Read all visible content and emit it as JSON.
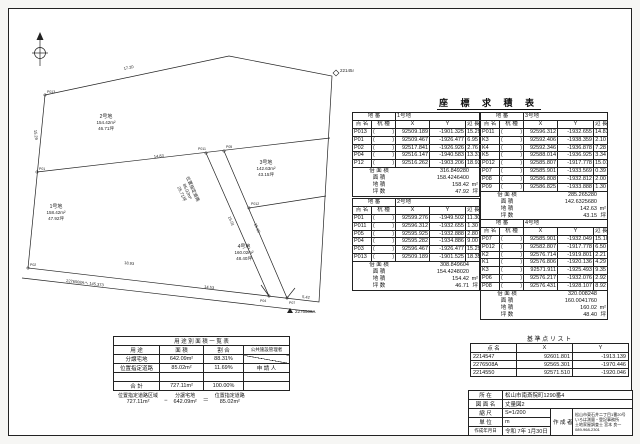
{
  "page_title": "座 標 求 積 表",
  "labels": {
    "chiban": "地 番",
    "point": "点 名",
    "kui": "杭 種",
    "x": "X",
    "y": "Y",
    "len": "辺 長",
    "bai": "倍 面 積",
    "men": "面 積",
    "chi": "地 積",
    "tsubo": "坪 数",
    "m2": "m²",
    "tsubo_u": "坪"
  },
  "coord_tables": [
    {
      "lot": "1号地",
      "rows": [
        {
          "name": "P013",
          "x": "92509.189",
          "y": "-1901.325",
          "len": "15.29"
        },
        {
          "name": "P01",
          "x": "92509.467",
          "y": "-1926.477",
          "len": "6.95"
        },
        {
          "name": "P02",
          "x": "92517.841",
          "y": "-1926.926",
          "len": "2.76"
        },
        {
          "name": "P04",
          "x": "92516.147",
          "y": "-1940.583",
          "len": "13.31"
        },
        {
          "name": "P12",
          "x": "92516.262",
          "y": "-1903.206",
          "len": "18.93"
        }
      ],
      "sums": {
        "bai": "316.849280",
        "men": "158.4246400",
        "chi": "158.42",
        "tsubo": "47.92"
      }
    },
    {
      "lot": "2号地",
      "rows": [
        {
          "name": "P01",
          "x": "92599.276",
          "y": "-1949.502",
          "len": "11.30"
        },
        {
          "name": "P011",
          "x": "92596.312",
          "y": "-1932.655",
          "len": "1.30"
        },
        {
          "name": "P05",
          "x": "92595.925",
          "y": "-1932.888",
          "len": "2.80"
        },
        {
          "name": "P04",
          "x": "92595.282",
          "y": "-1934.886",
          "len": "9.00"
        },
        {
          "name": "P03",
          "x": "92596.467",
          "y": "-1926.477",
          "len": "15.29"
        },
        {
          "name": "P013",
          "x": "92509.189",
          "y": "-1901.525",
          "len": "18.35"
        }
      ],
      "sums": {
        "bai": "308.849604",
        "men": "154.4248020",
        "chi": "154.42",
        "tsubo": "46.71"
      }
    },
    {
      "lot": "3号地",
      "rows": [
        {
          "name": "P011",
          "x": "92596.312",
          "y": "-1932.655",
          "len": "14.83"
        },
        {
          "name": "K3",
          "x": "92592.406",
          "y": "-1938.359",
          "len": "2.10"
        },
        {
          "name": "K4",
          "x": "92592.346",
          "y": "-1936.878",
          "len": "7.28"
        },
        {
          "name": "K5",
          "x": "92588.014",
          "y": "-1936.925",
          "len": "3.34"
        },
        {
          "name": "P012",
          "x": "92585.807",
          "y": "-1917.778",
          "len": "15.01"
        },
        {
          "name": "P07",
          "x": "92585.901",
          "y": "-1933.569",
          "len": "0.39"
        },
        {
          "name": "P08",
          "x": "92586.808",
          "y": "-1932.812",
          "len": "2.00"
        },
        {
          "name": "P09",
          "x": "92586.825",
          "y": "-1933.888",
          "len": "1.30"
        }
      ],
      "sums": {
        "bai": "285.265280",
        "men": "142.6325680",
        "chi": "142.63",
        "tsubo": "43.15"
      }
    },
    {
      "lot": "4号地",
      "rows": [
        {
          "name": "P07",
          "x": "92585.901",
          "y": "-1932.049",
          "len": "15.10"
        },
        {
          "name": "P012",
          "x": "92582.807",
          "y": "-1917.778",
          "len": "6.50"
        },
        {
          "name": "K2",
          "x": "92576.714",
          "y": "-1919.801",
          "len": "2.21"
        },
        {
          "name": "K1",
          "x": "92576.806",
          "y": "-1920.136",
          "len": "4.29"
        },
        {
          "name": "K3",
          "x": "92571.911",
          "y": "-1925.493",
          "len": "9.35"
        },
        {
          "name": "P06",
          "x": "92576.217",
          "y": "-1932.076",
          "len": "2.92"
        },
        {
          "name": "P08",
          "x": "92576.431",
          "y": "-1928.107",
          "len": "8.92"
        }
      ],
      "sums": {
        "bai": "320.008248",
        "men": "160.0041760",
        "chi": "160.02",
        "tsubo": "48.40"
      }
    }
  ],
  "benchmark_table": {
    "title": "基 準 点 リ ス ト",
    "headers": {
      "name": "点 名",
      "x": "X",
      "y": "Y"
    },
    "rows": [
      {
        "name": "2214547",
        "x": "92601.801",
        "y": "-1913.139"
      },
      {
        "name": "2276508A",
        "x": "92565.301",
        "y": "-1970.446"
      },
      {
        "name": "2214550",
        "x": "92571.510",
        "y": "-1920.046"
      }
    ]
  },
  "usage_table": {
    "title": "用 途 別 面 積 一 覧 表",
    "headers": {
      "use": "用 途",
      "area": "面 積",
      "ratio": "割 合",
      "manager": "公共施設管理者"
    },
    "rows": [
      {
        "use": "分譲宅地",
        "area": "642.09m²",
        "ratio": "88.31%",
        "manager": ""
      },
      {
        "use": "位置指定道路",
        "area": "85.02m²",
        "ratio": "11.69%",
        "manager": "申 請 人"
      },
      {
        "use": "",
        "area": "",
        "ratio": "",
        "manager": ""
      },
      {
        "use": "合 計",
        "area": "727.11m²",
        "ratio": "100.00%",
        "manager": ""
      }
    ]
  },
  "formula": {
    "a_label": "位置指定道路区域",
    "a": "727.11m²",
    "minus": "−",
    "b_label": "分譲宅地",
    "b": "642.09m²",
    "equals": "＝",
    "c_label": "位置指定道路",
    "c": "85.02m²"
  },
  "title_block": {
    "rows": {
      "location_label": "所  在",
      "location": "松山市南斎院町1290番4",
      "drawing_label": "図 面 名",
      "drawing": "丈量図2",
      "scale_label": "縮  尺",
      "scale": "S=1/200",
      "unit_label": "単  位",
      "unit": "m",
      "date_label": "作成年月日",
      "date": "令和 7年 1月30日",
      "maker_label": "作 成 者"
    },
    "maker_lines": [
      "松山市東石井二丁目1番20号",
      "いろは測量・登記事務所",
      "土地家屋調査士  宮本 良一",
      "089-968-2301"
    ]
  },
  "map": {
    "lots": [
      {
        "name": "2号地",
        "area": "154.42m²",
        "tsubo": "46.71坪"
      },
      {
        "name": "1号地",
        "area": "158.42m²",
        "tsubo": "47.92坪"
      },
      {
        "name": "3号地",
        "area": "142.63m²",
        "tsubo": "43.15坪"
      },
      {
        "name": "4号地",
        "area": "160.02m²",
        "tsubo": "48.40坪"
      }
    ],
    "road": {
      "name": "位置指定道路",
      "area": "85.02m²",
      "tsubo": "25.71坪"
    },
    "benchmarks": [
      "2214547",
      "2276508A"
    ],
    "points": [
      "P013",
      "P01",
      "P02",
      "P011",
      "P05",
      "P04",
      "P07",
      "P012"
    ],
    "edge_lengths": [
      "17.20",
      "14.83",
      "15.29",
      "15.01",
      "15.10",
      "18.93",
      "14.53",
      "5.42"
    ],
    "note": "2276508Aへ 145.373"
  }
}
